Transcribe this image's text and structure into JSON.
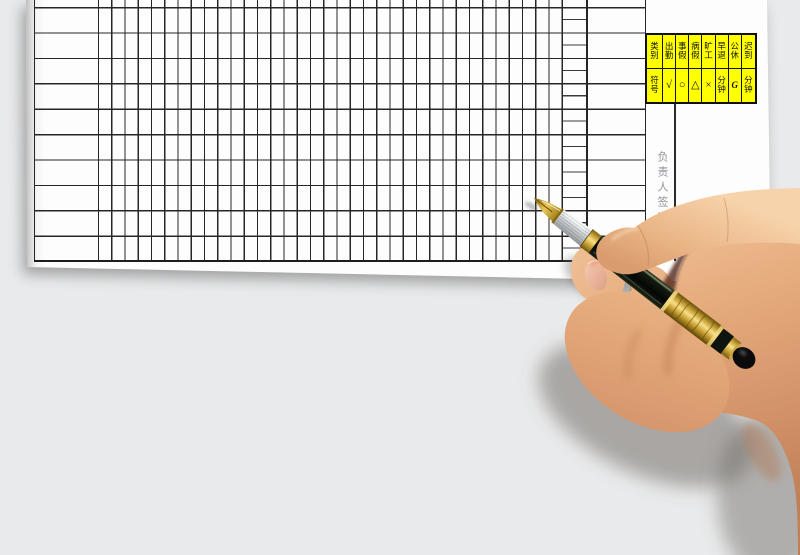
{
  "colors": {
    "background": "#e9eaeb",
    "paper": "#fdfdfd",
    "grid_line": "#262626",
    "legend_bg": "#ffff00",
    "pen_gold": "#d9b545",
    "pen_barrel": "#11160f",
    "skin": "#e3a87a"
  },
  "legend": {
    "rows": [
      {
        "header": "类别",
        "cells": [
          "出勤",
          "事假",
          "病假",
          "旷工",
          "早退",
          "公休",
          "迟到"
        ]
      },
      {
        "header": "符号",
        "cells": [
          "√",
          "○",
          "△",
          "×",
          "分钟",
          "G",
          "分钟"
        ]
      }
    ]
  },
  "signature_label": "负责人签字"
}
